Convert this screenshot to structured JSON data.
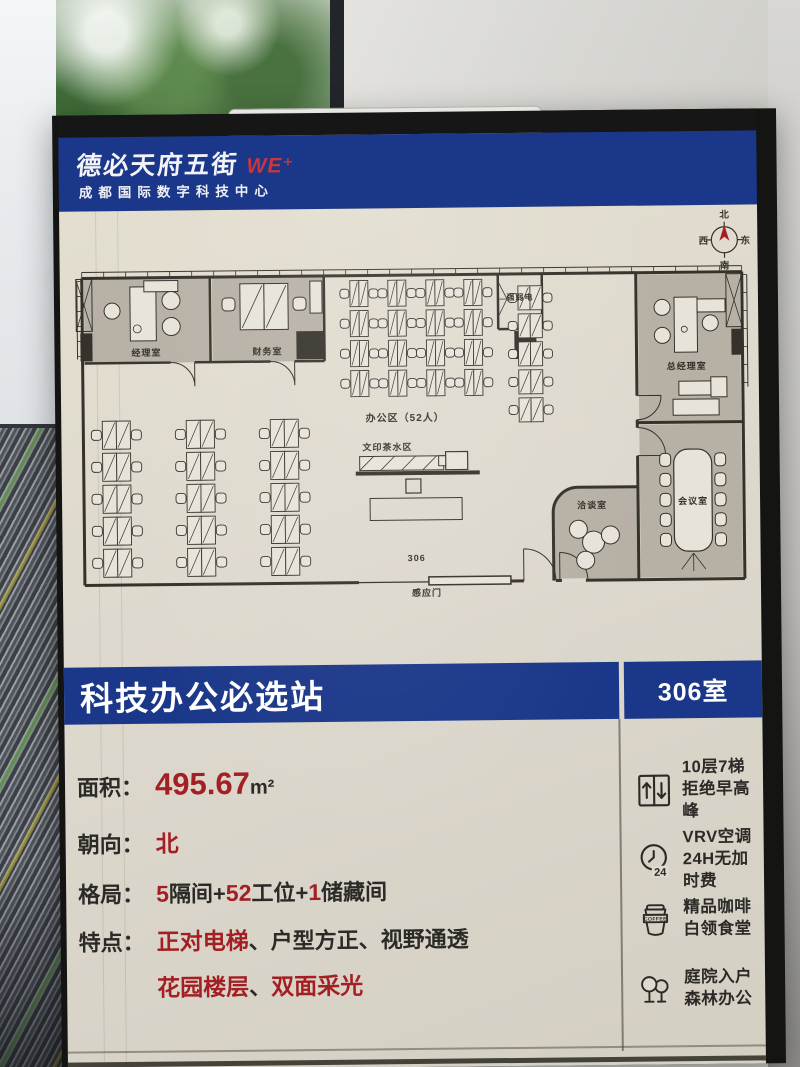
{
  "colors": {
    "blue": "#1b3789",
    "red": "#a31f24",
    "red_bright": "#c8373c",
    "ink": "#35322b",
    "cream": "#dedacf",
    "room": "#b7b0a5",
    "desk": "#e7e3d9"
  },
  "header": {
    "logo_text": "德必天府五街",
    "logo_mark": "WE⁺",
    "subtitle": "成都国际数字科技中心"
  },
  "compass": {
    "north": "北",
    "east": "东",
    "south": "南",
    "west": "西"
  },
  "banner": {
    "title": "科技办公必选站",
    "room": "306室"
  },
  "info": {
    "rows": [
      {
        "label": "面积：",
        "segments": [
          {
            "text": "495.67",
            "red": true,
            "big": true
          },
          {
            "text": "m²",
            "dim": true
          }
        ]
      },
      {
        "label": "朝向：",
        "segments": [
          {
            "text": "北",
            "red": true
          }
        ]
      },
      {
        "label": "格局：",
        "segments": [
          {
            "text": "5",
            "red": true
          },
          {
            "text": "隔间+"
          },
          {
            "text": "52",
            "red": true
          },
          {
            "text": "工位+"
          },
          {
            "text": "1",
            "red": true
          },
          {
            "text": "储藏间"
          }
        ]
      },
      {
        "label": "特点：",
        "segments": [
          {
            "text": "正对电梯",
            "red": true
          },
          {
            "text": "、户型方正、视野通透"
          }
        ]
      },
      {
        "label": "",
        "segments": [
          {
            "text": "花园楼层",
            "red": true
          },
          {
            "text": "、"
          },
          {
            "text": "双面采光",
            "red": true
          }
        ]
      }
    ]
  },
  "features": [
    {
      "icon": "elevator-icon",
      "lines": [
        "10层7梯",
        "拒绝早高峰"
      ]
    },
    {
      "icon": "clock-24-icon",
      "icon_text": "24",
      "lines": [
        "VRV空调",
        "24H无加时费"
      ]
    },
    {
      "icon": "coffee-icon",
      "icon_text": "COFFEE",
      "lines": [
        "精品咖啡",
        "白领食堂"
      ]
    },
    {
      "icon": "trees-icon",
      "lines": [
        "庭院入户",
        "森林办公"
      ]
    }
  ],
  "plan": {
    "shapes": [
      {
        "t": "rect",
        "x": 10,
        "y": 16,
        "w": 126,
        "h": 84,
        "fill": "@room"
      },
      {
        "t": "rect",
        "x": 138,
        "y": 16,
        "w": 112,
        "h": 84,
        "fill": "@room"
      },
      {
        "t": "rect",
        "x": 564,
        "y": 17,
        "w": 102,
        "h": 148,
        "fill": "@room"
      },
      {
        "t": "rect",
        "x": 564,
        "y": 167,
        "w": 102,
        "h": 153,
        "fill": "@room"
      },
      {
        "t": "path",
        "d": "M477,322 L477,254 A25 25 0 0 1 502,229 L561,229 L561,322 Z",
        "fill": "@room",
        "sw": 0
      },
      {
        "t": "line",
        "x1": 8,
        "y1": 9,
        "x2": 668,
        "y2": 9,
        "sw": 1
      },
      {
        "t": "ticks",
        "axis": "h",
        "x1": 8,
        "y1": 9,
        "x2": 668,
        "y2": 15,
        "step": 22
      },
      {
        "t": "line",
        "x1": 8,
        "y1": 15,
        "x2": 668,
        "y2": 15,
        "sw": 3
      },
      {
        "t": "line",
        "x1": 8,
        "y1": 15,
        "x2": 8,
        "y2": 322,
        "sw": 3
      },
      {
        "t": "line",
        "x1": 668,
        "y1": 15,
        "x2": 668,
        "y2": 322,
        "sw": 3
      },
      {
        "t": "line",
        "x1": 673,
        "y1": 18,
        "x2": 673,
        "y2": 130,
        "sw": 1
      },
      {
        "t": "ticks",
        "axis": "v",
        "x1": 668,
        "y1": 18,
        "x2": 673,
        "y2": 130,
        "step": 18
      },
      {
        "t": "line",
        "x1": 3,
        "y1": 18,
        "x2": 3,
        "y2": 96,
        "sw": 1
      },
      {
        "t": "ticks",
        "axis": "v",
        "x1": 3,
        "y1": 18,
        "x2": 8,
        "y2": 96,
        "step": 15
      },
      {
        "t": "line",
        "x1": 8,
        "y1": 322,
        "x2": 282,
        "y2": 322,
        "sw": 3
      },
      {
        "t": "line",
        "x1": 282,
        "y1": 322,
        "x2": 352,
        "y2": 322,
        "sw": 1.2
      },
      {
        "t": "rect",
        "x": 352,
        "y": 317,
        "w": 82,
        "h": 8,
        "fill": "@desk",
        "sw": 1.5
      },
      {
        "t": "line",
        "x1": 434,
        "y1": 322,
        "x2": 447,
        "y2": 322,
        "sw": 3
      },
      {
        "t": "path",
        "d": "M447,322 L447,290 M447,290 A32 32 0 0 1 479,322",
        "sw": 1
      },
      {
        "t": "line",
        "x1": 479,
        "y1": 322,
        "x2": 668,
        "y2": 322,
        "sw": 3
      },
      {
        "t": "line",
        "x1": 485,
        "y1": 322,
        "x2": 509,
        "y2": 322,
        "sw": 4,
        "stroke": "@cream"
      },
      {
        "t": "path",
        "d": "M483,322 L483,294 M483,294 A28 28 0 0 1 511,322",
        "sw": 1
      },
      {
        "t": "line",
        "x1": 136,
        "y1": 15,
        "x2": 136,
        "y2": 100,
        "sw": 2.5
      },
      {
        "t": "line",
        "x1": 250,
        "y1": 15,
        "x2": 250,
        "y2": 100,
        "sw": 2.5
      },
      {
        "t": "line",
        "x1": 10,
        "y1": 100,
        "x2": 96,
        "y2": 100,
        "sw": 2.5
      },
      {
        "t": "path",
        "d": "M120,100 L120,124 M120,124 A24 24 0 0 0 96,100",
        "sw": 1
      },
      {
        "t": "line",
        "x1": 120,
        "y1": 100,
        "x2": 138,
        "y2": 100,
        "sw": 2.5
      },
      {
        "t": "line",
        "x1": 138,
        "y1": 100,
        "x2": 196,
        "y2": 100,
        "sw": 2.5
      },
      {
        "t": "path",
        "d": "M220,100 L220,124 M220,124 A24 24 0 0 0 196,100",
        "sw": 1
      },
      {
        "t": "line",
        "x1": 220,
        "y1": 100,
        "x2": 250,
        "y2": 100,
        "sw": 2.5
      },
      {
        "t": "line",
        "x1": 424,
        "y1": 15,
        "x2": 424,
        "y2": 70,
        "sw": 2.5
      },
      {
        "t": "line",
        "x1": 468,
        "y1": 15,
        "x2": 468,
        "y2": 70,
        "sw": 2.5
      },
      {
        "t": "line",
        "x1": 424,
        "y1": 70,
        "x2": 468,
        "y2": 70,
        "sw": 2.5
      },
      {
        "t": "path",
        "d": "M424,22 L433,40 L424,40 Z M424,58 L433,40 L424,40 Z",
        "sw": 0.8
      },
      {
        "t": "line",
        "x1": 562,
        "y1": 15,
        "x2": 562,
        "y2": 138,
        "sw": 3
      },
      {
        "t": "path",
        "d": "M562,138 L586,138 M586,138 A24 24 0 0 1 562,162",
        "sw": 1
      },
      {
        "t": "line",
        "x1": 562,
        "y1": 162,
        "x2": 562,
        "y2": 170,
        "sw": 3
      },
      {
        "t": "path",
        "d": "M562,198 L590,198 M590,198 A28 28 0 0 0 562,170",
        "sw": 1
      },
      {
        "t": "line",
        "x1": 562,
        "y1": 198,
        "x2": 562,
        "y2": 322,
        "sw": 3
      },
      {
        "t": "line",
        "x1": 562,
        "y1": 165,
        "x2": 668,
        "y2": 165,
        "sw": 3
      },
      {
        "t": "path",
        "d": "M477,322 L477,254 A25 25 0 0 1 502,229 L561,229",
        "sw": 3
      },
      {
        "t": "rect",
        "x": 6,
        "y": 70,
        "w": 12,
        "h": 28,
        "fill": "@ink"
      },
      {
        "t": "rect",
        "x": 222,
        "y": 70,
        "w": 28,
        "h": 28,
        "fill": "@ink"
      },
      {
        "t": "rect",
        "x": 440,
        "y": 72,
        "w": 22,
        "h": 28,
        "fill": "@ink"
      },
      {
        "t": "rect",
        "x": 657,
        "y": 72,
        "w": 11,
        "h": 26,
        "fill": "@ink"
      },
      {
        "t": "xbox",
        "x": 2,
        "y": 16,
        "w": 16,
        "h": 52
      },
      {
        "t": "xbox",
        "x": 652,
        "y": 17,
        "w": 16,
        "h": 53
      },
      {
        "t": "rect",
        "x": 56,
        "y": 24,
        "w": 26,
        "h": 54,
        "fill": "@desk",
        "sw": 1
      },
      {
        "t": "rect",
        "x": 70,
        "y": 18,
        "w": 34,
        "h": 11,
        "fill": "@desk",
        "sw": 1
      },
      {
        "t": "circle",
        "cx": 63,
        "cy": 66,
        "r": 4,
        "sw": 0.8
      },
      {
        "t": "circle",
        "cx": 38,
        "cy": 48,
        "r": 8,
        "fill": "@desk",
        "sw": 1
      },
      {
        "t": "circle",
        "cx": 97,
        "cy": 38,
        "r": 9,
        "fill": "@desk",
        "sw": 1
      },
      {
        "t": "circle",
        "cx": 97,
        "cy": 64,
        "r": 9,
        "fill": "@desk",
        "sw": 1
      },
      {
        "t": "rect",
        "x": 166,
        "y": 22,
        "w": 24,
        "h": 46,
        "fill": "@desk",
        "sw": 1,
        "diag": true
      },
      {
        "t": "rect",
        "x": 190,
        "y": 22,
        "w": 24,
        "h": 46,
        "fill": "@desk",
        "sw": 1,
        "diag": true
      },
      {
        "t": "rect",
        "x": 148,
        "y": 36,
        "w": 13,
        "h": 13,
        "rx": 4,
        "fill": "@desk",
        "sw": 1
      },
      {
        "t": "rect",
        "x": 219,
        "y": 36,
        "w": 13,
        "h": 13,
        "rx": 4,
        "fill": "@desk",
        "sw": 1
      },
      {
        "t": "rect",
        "x": 236,
        "y": 20,
        "w": 12,
        "h": 32,
        "fill": "@desk",
        "sw": 1
      },
      {
        "t": "cluster",
        "x": 266,
        "y": 20,
        "cols": 4,
        "rows": 4,
        "cp": 38,
        "rp": 30,
        "dw": 9,
        "dh": 26,
        "ch": 9
      },
      {
        "t": "cluster",
        "x": 434,
        "y": 27,
        "cols": 1,
        "rows": 5,
        "cp": 46,
        "rp": 28,
        "dw": 12,
        "dh": 24,
        "ch": 9
      },
      {
        "t": "cluster",
        "x": 16,
        "y": 158,
        "cols": 3,
        "rows": 5,
        "cp": 84,
        "rp": 32,
        "dw": 14,
        "dh": 28,
        "ch": 10
      },
      {
        "t": "rect",
        "x": 284,
        "y": 196,
        "w": 84,
        "h": 14,
        "fill": "@desk",
        "sw": 1
      },
      {
        "t": "path",
        "d": "M284,210 L298,196 M305,210 L319,196 M326,210 L340,196 M347,210 L361,196",
        "sw": 0.8
      },
      {
        "t": "rect",
        "x": 370,
        "y": 192,
        "w": 22,
        "h": 18,
        "fill": "@desk",
        "sw": 1.2
      },
      {
        "t": "rect",
        "x": 363,
        "y": 196,
        "w": 7,
        "h": 10,
        "fill": "@desk",
        "sw": 1
      },
      {
        "t": "line",
        "x1": 280,
        "y1": 213,
        "x2": 404,
        "y2": 213,
        "sw": 4
      },
      {
        "t": "rect",
        "x": 330,
        "y": 219,
        "w": 15,
        "h": 14,
        "sw": 1.2
      },
      {
        "t": "rect",
        "x": 294,
        "y": 238,
        "w": 92,
        "h": 22,
        "sw": 1
      },
      {
        "t": "rect",
        "x": 600,
        "y": 40,
        "w": 23,
        "h": 55,
        "fill": "@desk",
        "sw": 1
      },
      {
        "t": "rect",
        "x": 623,
        "y": 42,
        "w": 28,
        "h": 13,
        "fill": "@desk",
        "sw": 1
      },
      {
        "t": "circle",
        "cx": 610,
        "cy": 72,
        "r": 3,
        "sw": 0.8
      },
      {
        "t": "circle",
        "cx": 588,
        "cy": 50,
        "r": 8,
        "fill": "@desk",
        "sw": 1
      },
      {
        "t": "circle",
        "cx": 588,
        "cy": 78,
        "r": 8,
        "fill": "@desk",
        "sw": 1
      },
      {
        "t": "circle",
        "cx": 636,
        "cy": 66,
        "r": 8,
        "fill": "@desk",
        "sw": 1
      },
      {
        "t": "rect",
        "x": 604,
        "y": 124,
        "w": 34,
        "h": 14,
        "fill": "@desk",
        "sw": 1
      },
      {
        "t": "rect",
        "x": 598,
        "y": 142,
        "w": 46,
        "h": 16,
        "fill": "@desk",
        "sw": 1
      },
      {
        "t": "rect",
        "x": 636,
        "y": 120,
        "w": 16,
        "h": 20,
        "fill": "@desk",
        "sw": 1
      },
      {
        "t": "rect",
        "x": 598,
        "y": 192,
        "w": 38,
        "h": 102,
        "rx": 14,
        "fill": "@desk",
        "sw": 1.2
      },
      {
        "t": "rect",
        "x": 584,
        "y": 196,
        "w": 11,
        "h": 13,
        "rx": 4,
        "fill": "@desk",
        "sw": 1
      },
      {
        "t": "rect",
        "x": 584,
        "y": 216,
        "w": 11,
        "h": 13,
        "rx": 4,
        "fill": "@desk",
        "sw": 1
      },
      {
        "t": "rect",
        "x": 584,
        "y": 236,
        "w": 11,
        "h": 13,
        "rx": 4,
        "fill": "@desk",
        "sw": 1
      },
      {
        "t": "rect",
        "x": 584,
        "y": 256,
        "w": 11,
        "h": 13,
        "rx": 4,
        "fill": "@desk",
        "sw": 1
      },
      {
        "t": "rect",
        "x": 584,
        "y": 276,
        "w": 11,
        "h": 13,
        "rx": 4,
        "fill": "@desk",
        "sw": 1
      },
      {
        "t": "rect",
        "x": 639,
        "y": 196,
        "w": 11,
        "h": 13,
        "rx": 4,
        "fill": "@desk",
        "sw": 1
      },
      {
        "t": "rect",
        "x": 639,
        "y": 216,
        "w": 11,
        "h": 13,
        "rx": 4,
        "fill": "@desk",
        "sw": 1
      },
      {
        "t": "rect",
        "x": 639,
        "y": 236,
        "w": 11,
        "h": 13,
        "rx": 4,
        "fill": "@desk",
        "sw": 1
      },
      {
        "t": "rect",
        "x": 639,
        "y": 256,
        "w": 11,
        "h": 13,
        "rx": 4,
        "fill": "@desk",
        "sw": 1
      },
      {
        "t": "rect",
        "x": 639,
        "y": 276,
        "w": 11,
        "h": 13,
        "rx": 4,
        "fill": "@desk",
        "sw": 1
      },
      {
        "t": "path",
        "d": "M617,296 L605,312 M617,296 L629,312 M617,296 L617,314",
        "sw": 0.8
      },
      {
        "t": "circle",
        "cx": 517,
        "cy": 284,
        "r": 11,
        "fill": "@desk",
        "sw": 1
      },
      {
        "t": "circle",
        "cx": 502,
        "cy": 271,
        "r": 9,
        "fill": "@desk",
        "sw": 1
      },
      {
        "t": "circle",
        "cx": 534,
        "cy": 277,
        "r": 9,
        "fill": "@desk",
        "sw": 1
      },
      {
        "t": "circle",
        "cx": 509,
        "cy": 302,
        "r": 9,
        "fill": "@desk",
        "sw": 1
      },
      {
        "t": "text",
        "x": 72,
        "y": 93,
        "txt": "经理室"
      },
      {
        "t": "text",
        "x": 193,
        "y": 93,
        "txt": "财务室"
      },
      {
        "t": "text",
        "x": 446,
        "y": 41,
        "s": 8,
        "txt": "强弱电"
      },
      {
        "t": "text",
        "x": 330,
        "y": 161,
        "s": 10,
        "txt": "办公区（52人）"
      },
      {
        "t": "text",
        "x": 312,
        "y": 190,
        "txt": "文印茶水区"
      },
      {
        "t": "text",
        "x": 612,
        "y": 112,
        "txt": "总经理室"
      },
      {
        "t": "text",
        "x": 516,
        "y": 250,
        "txt": "洽谈室"
      },
      {
        "t": "text",
        "x": 617,
        "y": 247,
        "txt": "会议室"
      },
      {
        "t": "text",
        "x": 340,
        "y": 301,
        "txt": "306"
      },
      {
        "t": "text",
        "x": 350,
        "y": 336,
        "txt": "感应门"
      }
    ]
  }
}
